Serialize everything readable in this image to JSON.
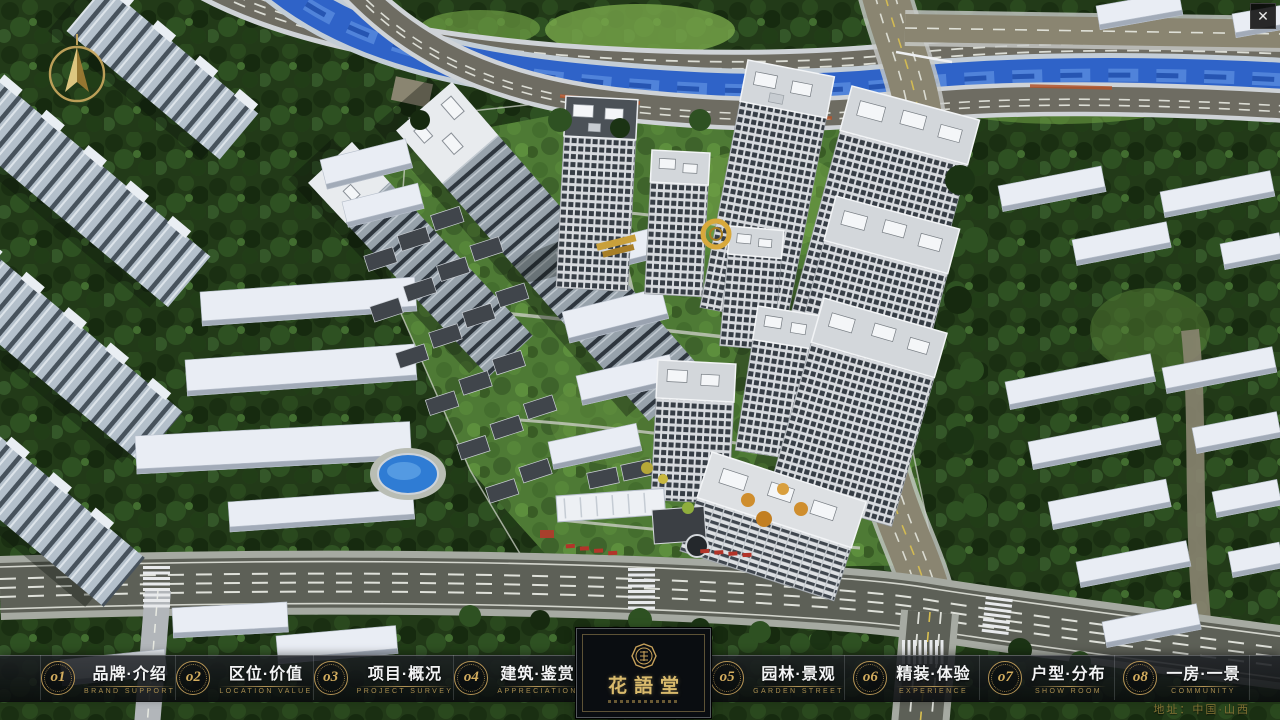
{
  "app": {
    "close_glyph": "✕"
  },
  "menu": {
    "items": [
      {
        "num": "o1",
        "label": "品牌·介绍",
        "sub": "BRAND SUPPORT"
      },
      {
        "num": "o2",
        "label": "区位·价值",
        "sub": "LOCATION VALUE"
      },
      {
        "num": "o3",
        "label": "项目·概况",
        "sub": "PROJECT SURVEY"
      },
      {
        "num": "o4",
        "label": "建筑·鉴赏",
        "sub": "APPRECIATION"
      },
      {
        "num": "o5",
        "label": "园林·景观",
        "sub": "GARDEN STREET"
      },
      {
        "num": "o6",
        "label": "精装·体验",
        "sub": "EXPERIENCE"
      },
      {
        "num": "o7",
        "label": "户型·分布",
        "sub": "SHOW ROOM"
      },
      {
        "num": "o8",
        "label": "一房·一景",
        "sub": "COMMUNITY"
      }
    ]
  },
  "logo": {
    "title": "花語堂"
  },
  "footer": {
    "address": "地址：中国·山西"
  },
  "colors": {
    "gold": "#c7a15a",
    "bar_bg": "rgba(10,12,15,0.86)",
    "river": "#2f63c8",
    "asphalt": "#5d6057",
    "tan_road": "#8a8571"
  }
}
